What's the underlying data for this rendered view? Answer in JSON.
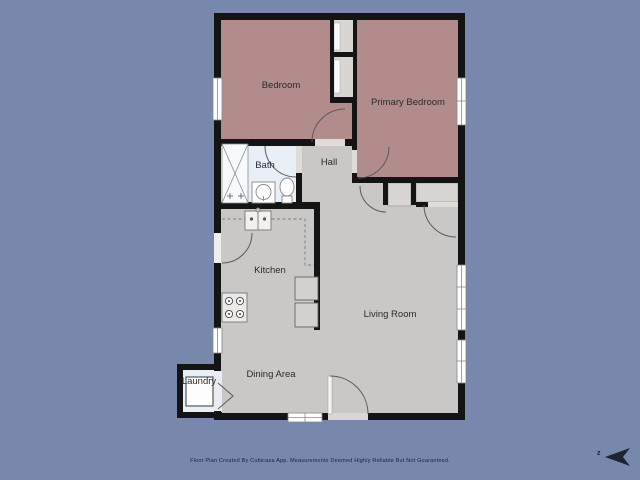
{
  "floor_plan": {
    "rooms": [
      {
        "name": "bedroom",
        "label": "Bedroom"
      },
      {
        "name": "primary-bedroom",
        "label": "Primary Bedroom"
      },
      {
        "name": "bath",
        "label": "Bath"
      },
      {
        "name": "hall",
        "label": "Hall"
      },
      {
        "name": "kitchen",
        "label": "Kitchen"
      },
      {
        "name": "living-room",
        "label": "Living Room"
      },
      {
        "name": "dining-area",
        "label": "Dining Area"
      },
      {
        "name": "laundry",
        "label": "Laundry"
      }
    ],
    "fixtures": [
      "shower",
      "toilet",
      "bathroom-sink",
      "kitchen-sink",
      "stove",
      "washer",
      "appliances"
    ],
    "colors": {
      "background": "#7888ac",
      "walls": "#141414",
      "bedroom_fill": "#b18c8b",
      "common_fill": "#cac8c6",
      "wet_room_fill": "#e9eff7",
      "closet_fill": "#d8d5d2",
      "label_text": "#2b2b2b",
      "footer_text": "#17223c"
    },
    "compass": {
      "label": "z"
    },
    "footer": {
      "disclaimer": "Floor Plan Created By Cubicasa App. Measurements Deemed Highly Reliable But Not Guaranteed."
    }
  }
}
